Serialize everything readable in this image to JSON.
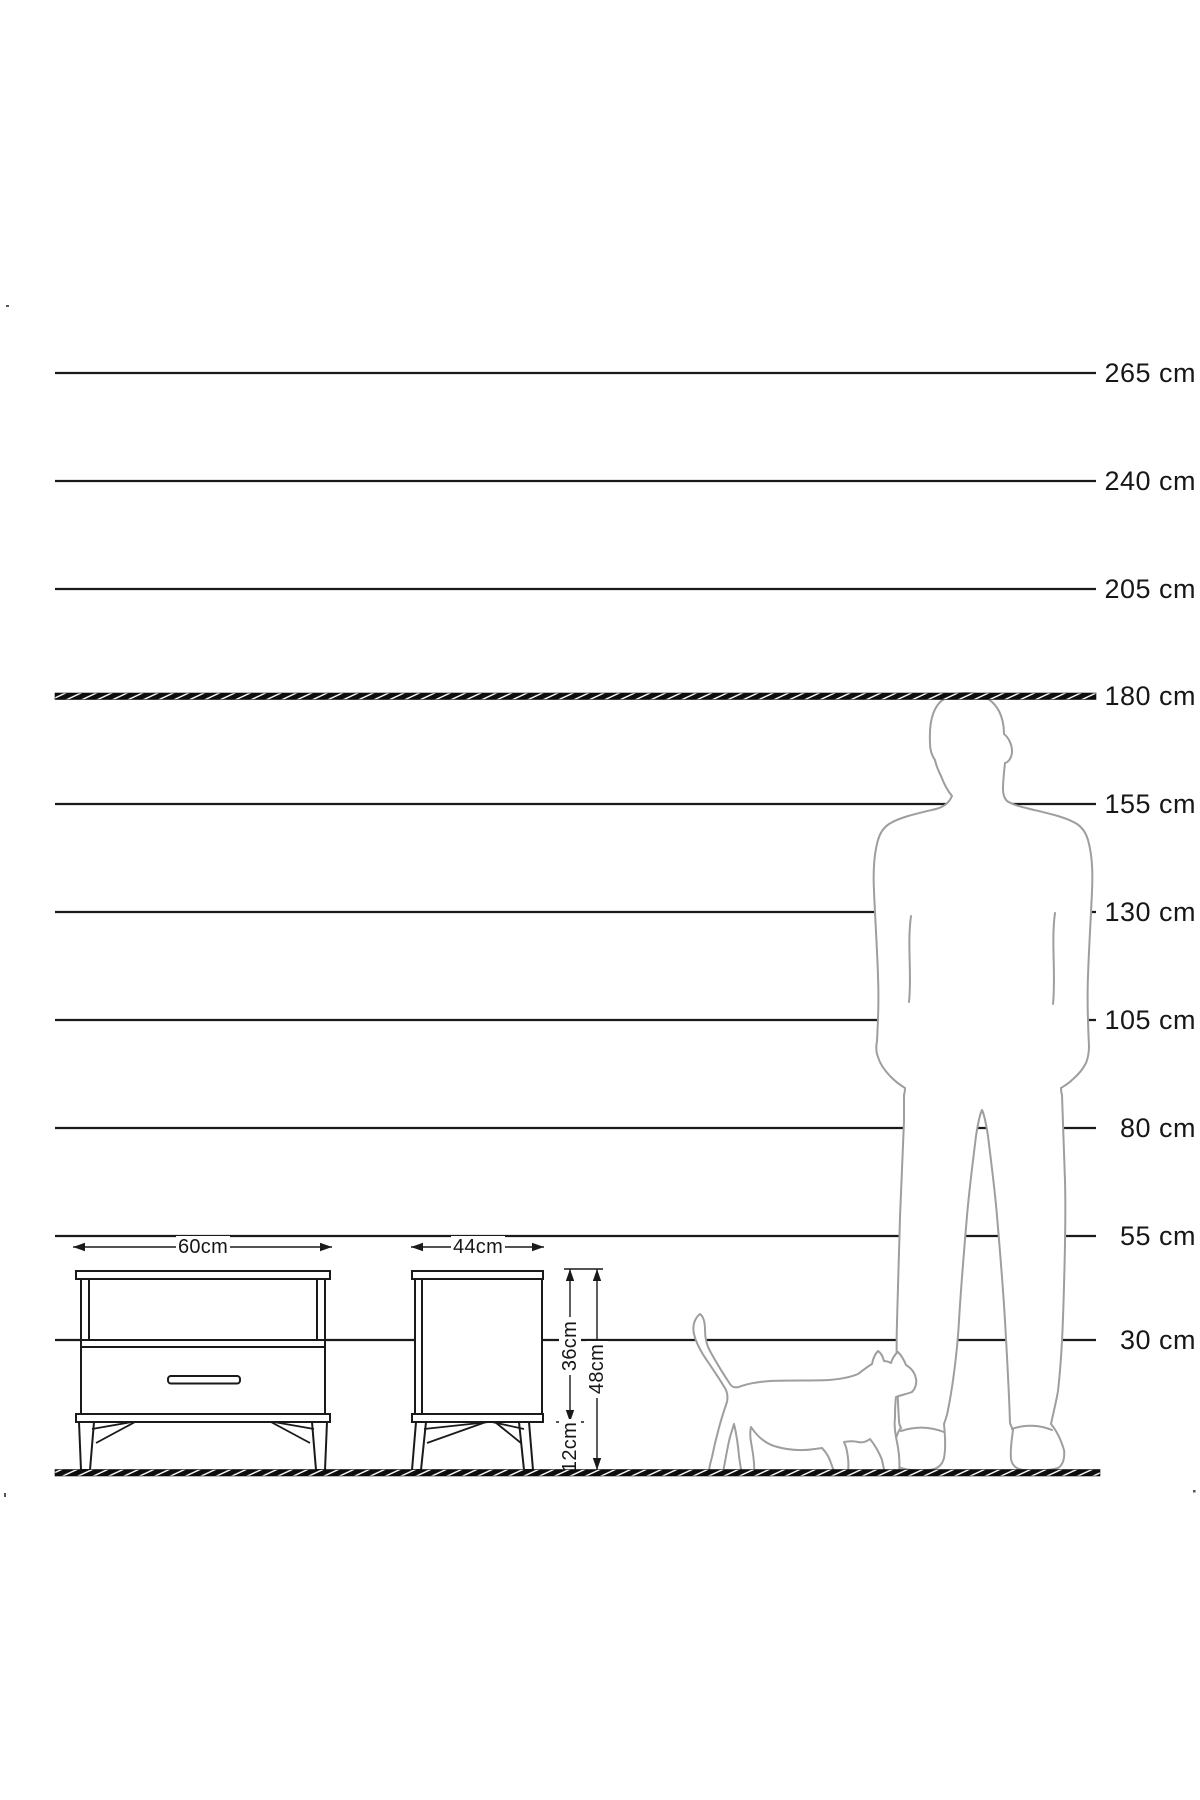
{
  "ruler": {
    "unit": "cm",
    "labels": [
      "265 cm",
      "240 cm",
      "205 cm",
      "180 cm",
      "155 cm",
      "130 cm",
      "105 cm",
      "80 cm",
      "55 cm",
      "30 cm"
    ]
  },
  "dimensions": {
    "front_width": "60cm",
    "side_depth": "44cm",
    "upper_height": "36cm",
    "total_height": "48cm",
    "leg_height": "12cm"
  },
  "figures": {
    "man": "man-silhouette-for-scale",
    "cat": "cat-silhouette-for-scale",
    "furniture_front": "nightstand-front-view",
    "furniture_side": "nightstand-side-view"
  },
  "colors": {
    "ink": "#1a1a1a",
    "silhouette": "#9e9e9e",
    "background": "#ffffff"
  }
}
